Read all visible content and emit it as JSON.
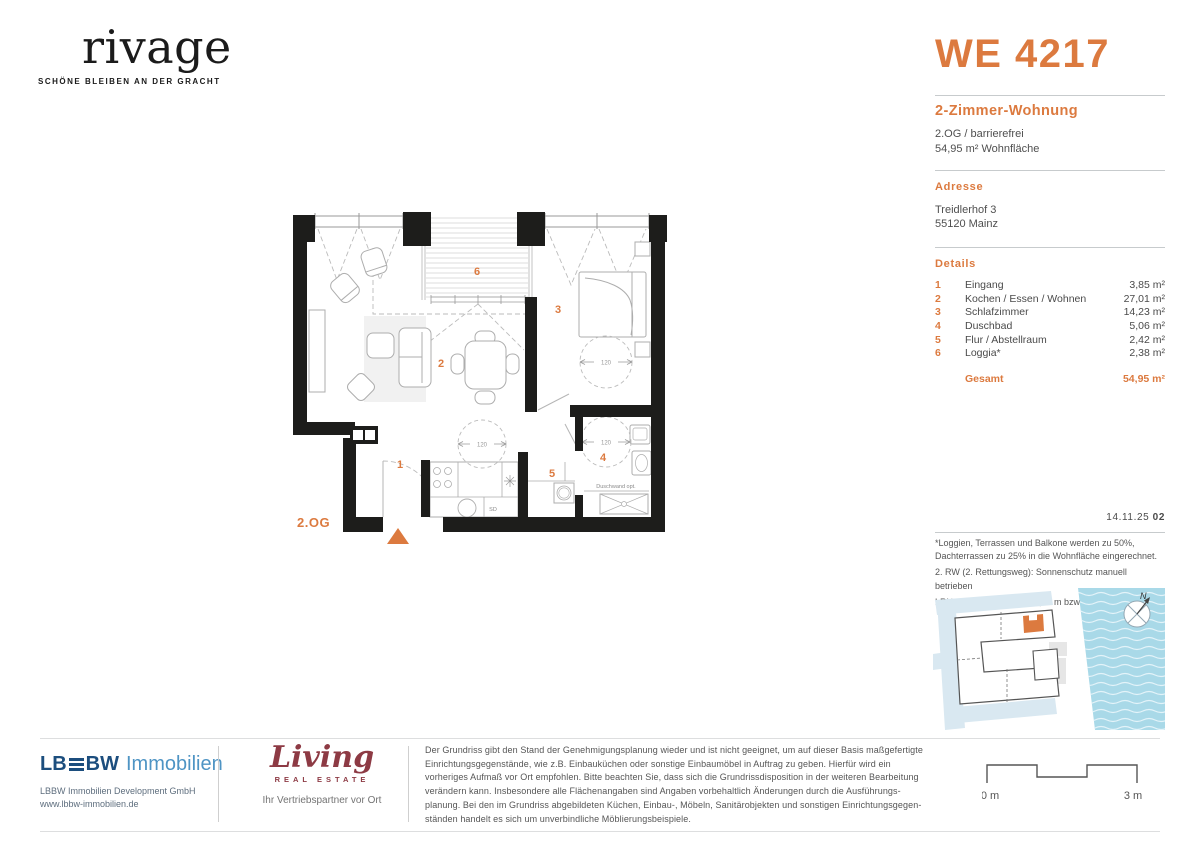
{
  "brand": {
    "logo_text": "rivage",
    "tagline": "SCHÖNE BLEIBEN AN DER GRACHT"
  },
  "unit": {
    "code": "WE 4217",
    "type": "2-Zimmer-Wohnung",
    "floor": "2.OG / barrierefrei",
    "living_area": "54,95 m² Wohnfläche"
  },
  "address": {
    "heading": "Adresse",
    "street": "Treidlerhof 3",
    "city": "55120 Mainz"
  },
  "details": {
    "heading": "Details",
    "rooms": [
      {
        "no": "1",
        "name": "Eingang",
        "area": "3,85 m²"
      },
      {
        "no": "2",
        "name": "Kochen / Essen / Wohnen",
        "area": "27,01 m²"
      },
      {
        "no": "3",
        "name": "Schlafzimmer",
        "area": "14,23 m²"
      },
      {
        "no": "4",
        "name": "Duschbad",
        "area": "5,06 m²"
      },
      {
        "no": "5",
        "name": "Flur / Abstellraum",
        "area": "2,42 m²"
      },
      {
        "no": "6",
        "name": "Loggia*",
        "area": "2,38 m²"
      }
    ],
    "total_label": "Gesamt",
    "total_area": "54,95 m²"
  },
  "plan": {
    "floor_label": "2.OG",
    "turning_circle": "120",
    "shower_note": "Duschwand opt.",
    "appliance": "SD"
  },
  "meta": {
    "date": "14.11.25",
    "revision": "02"
  },
  "footnotes": [
    "*Loggien, Terrassen und Balkone werden zu 50%, Dachterrassen zu 25% in die Wohnfläche eingerechnet.",
    "2. RW (2. Rettungsweg): Sonnenschutz manuell betrieben",
    "LRH (lichte Raumhöhe): 2,65 m bzw. wie angegeben"
  ],
  "sitemap": {
    "north_label": "N"
  },
  "footer": {
    "lbbw": {
      "name_left": "LB",
      "name_right": "BW",
      "name_suffix": "Immobilien",
      "line1": "LBBW Immobilien Development GmbH",
      "line2": "www.lbbw-immobilien.de"
    },
    "living": {
      "script": "Living",
      "subtitle": "REAL ESTATE",
      "tagline": "Ihr Vertriebspartner vor Ort"
    },
    "disclaimer_lines": [
      "Der Grundriss gibt den Stand der Genehmigungsplanung wieder und ist nicht geeignet, um auf dieser Basis maßgefertigte",
      "Einrichtungsgegenstände, wie z.B. Einbauküchen oder sonstige Einbaumöbel in Auftrag zu geben. Hierfür wird ein",
      "vorheriges Aufmaß vor Ort empfohlen. Bitte beachten Sie, dass sich die Grundrissdisposition in der weiteren Bearbeitung",
      "verändern kann. Insbesondere alle Flächenangaben sind Angaben vorbehaltlich Änderungen durch die Ausführungs-",
      "planung. Bei den im Grundriss abgebildeten Küchen, Einbau-, Möbeln, Sanitärobjekten und sonstigen Einrichtungsgegen-",
      "ständen handelt es sich um unverbindliche Möblierungsbeispiele."
    ],
    "scale": {
      "start": "0 m",
      "end": "3 m"
    }
  }
}
